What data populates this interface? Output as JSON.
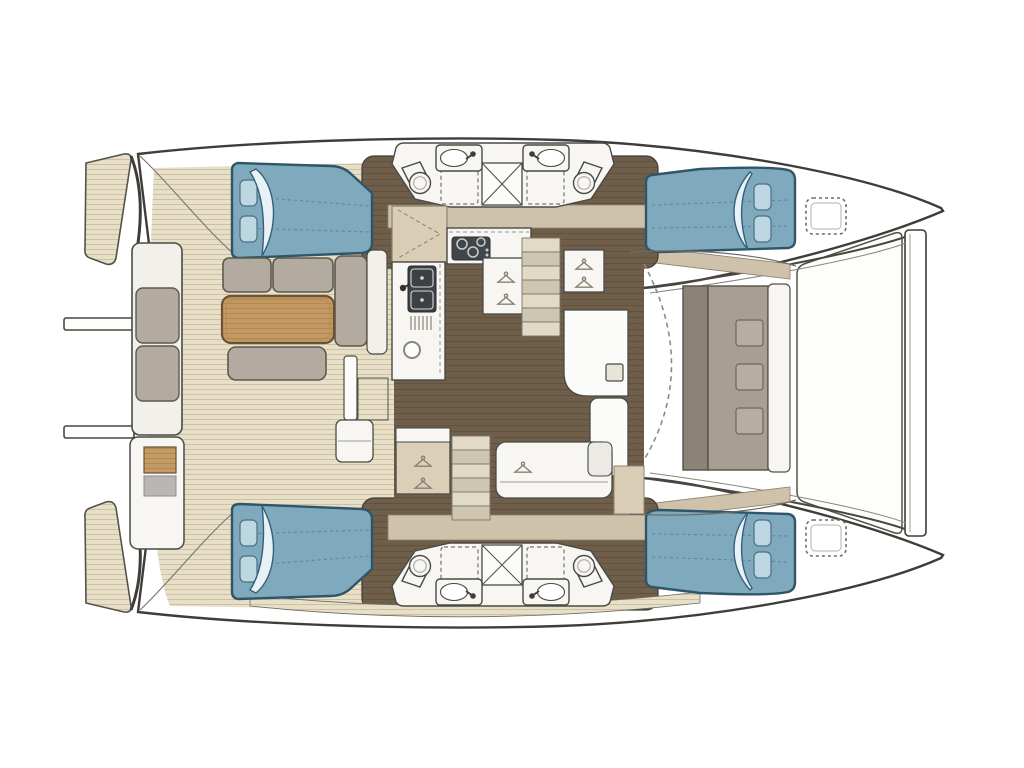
{
  "diagram": {
    "title": "catamaran-floor-plan",
    "type": "boat-deck-plan-top-view",
    "orientation": {
      "bow": "right",
      "stern": "left"
    }
  },
  "features": {
    "hull_count": 2,
    "double_berths": 4,
    "berth_pillows_each": 2,
    "heads_bathrooms": 4,
    "bathroom_sinks": 4,
    "toilets": 4,
    "shower_stalls_x_marked": 2,
    "dashed_shower_floors": 4,
    "stair_flights": 2,
    "hanger_icon_lockers": 4,
    "galley": [
      "stove-3-burner",
      "double-sink",
      "drainer",
      "round-basin",
      "corner-cabinet"
    ],
    "cockpit": [
      "wood-table",
      "l-sofa",
      "side-bench",
      "front-bench",
      "aft-bench",
      "wet-bar"
    ],
    "foredeck": [
      "forward-bench",
      "door-swing-arc",
      "trampoline",
      "crossbeam",
      "2-deck-hatches"
    ],
    "stern": [
      "2-stern-wings",
      "2-boarding-bars"
    ]
  },
  "colors": {
    "outline": "#3f3d38",
    "hull_white": "#ffffff",
    "fixture_white": "#f7f6f3",
    "panel_white": "#f2f0ea",
    "teak_base": "#e8dfc9",
    "teak_stripe": "#cec0a2",
    "darkwood_base": "#6f5e4a",
    "darkwood_stripe": "#61513f",
    "wood_base": "#c39a65",
    "wood_stripe": "#b4874e",
    "wood_outline": "#6b5233",
    "bed_fill": "#7fa9bd",
    "bed_outline": "#2f5668",
    "pillow_fill": "#bcd7e1",
    "blanket_fill": "#e8f1f5",
    "cushion_fill": "#b3aba0",
    "bench_back": "#8c8376",
    "bench_seat": "#a89f92",
    "bench_cushion": "#b7aea1",
    "wall_beige": "#cfc2ab",
    "wardrobe_tan": "#dbcfb8",
    "corner_cabinet": "#d9cdb6",
    "stove_dark": "#41464a",
    "stove_ring": "#c9ccce",
    "sink_dark": "#3d4144",
    "metal_gray": "#b9b7b4",
    "stair_light": "#e2dac7",
    "stair_dark": "#cfc6b1",
    "arc_gray": "#8b8b86",
    "hatch_dash": "#6e6e68",
    "tramp_stroke": "#55524c"
  }
}
